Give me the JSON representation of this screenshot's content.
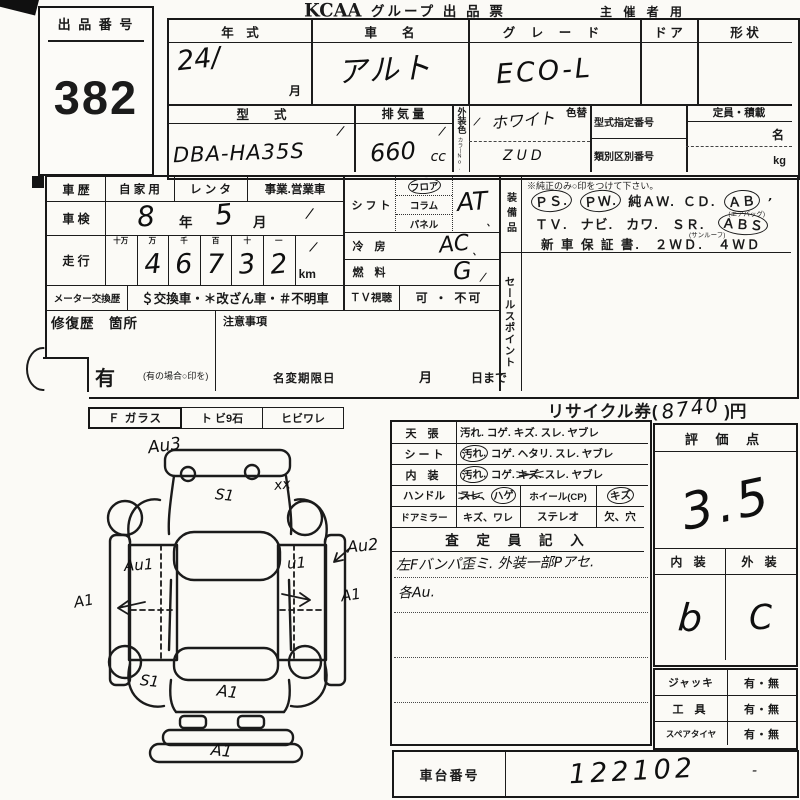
{
  "colors": {
    "ink": "#1c1c1c",
    "paper": "#fbfaf6"
  },
  "marks": {
    "tick": "/",
    "tick2": "、",
    "apos": "’",
    "dash": "-"
  },
  "header": {
    "lot_label": "出 品 番 号",
    "lot_number": "382",
    "brand": "KCAA",
    "title": "グループ 出 品 票",
    "audience": "主 催 者 用"
  },
  "top_table": {
    "year_label": "年　式",
    "year_value": "24/",
    "month_label": "月",
    "name_label": "車　　名",
    "name_value": "アルト",
    "grade_label": "グ レ ー ド",
    "grade_value": "ECO-L",
    "door_label": "ド ア",
    "shape_label": "形 状",
    "model_label": "型　　式",
    "model_value": "DBA-HA35S",
    "disp_label": "排 気 量",
    "disp_value": "660",
    "disp_unit": "cc",
    "ext_color_label": "外装色",
    "color_no_label": "カラーNo.",
    "color_change_label": "色替",
    "color_value": "ホワイト",
    "color_no_value": "ZUD",
    "type_no_label": "型式指定番号",
    "class_no_label": "類別区別番号",
    "capacity_label": "定員・積載",
    "persons_unit": "名",
    "weight_unit": "kg"
  },
  "history": {
    "label": "車 歴",
    "private": "自 家 用",
    "rental": "レ ン タ",
    "business": "事業.営業車",
    "inspection_label": "車 検",
    "insp_year": "8",
    "insp_year_suffix": "年",
    "insp_month": "5",
    "insp_month_suffix": "月",
    "mileage_label": "走 行",
    "digit_headers": [
      "十万",
      "万",
      "千",
      "百",
      "十",
      "一"
    ],
    "digits": [
      "",
      "4",
      "6",
      "7",
      "3",
      "2"
    ],
    "mileage_unit": "km",
    "meter_label": "メーター交換歴",
    "meter_options": "＄交換車・＊改ざん車・＃不明車",
    "tv_label": "ＴＶ視聴",
    "tv_options": "可 ・ 不可",
    "repair_label": "修復歴　箇所",
    "caution_label": "注意事項",
    "exist_label": "有",
    "exist_note": "(有の場合○印を)",
    "name_change_label": "名変期限日",
    "nc_month": "月",
    "nc_day": "日まで"
  },
  "drivetrain": {
    "shift_label": "シ フ ト",
    "shift_opt1": "フロア",
    "shift_opt2": "コラム",
    "shift_opt3": "パネル",
    "shift_value": "AT",
    "ac_label": "冷 房",
    "ac_value": "AC",
    "fuel_label": "燃 料",
    "fuel_value": "G"
  },
  "equipment": {
    "label": "装備品",
    "note": "※純正のみ○印をつけて下さい。",
    "ps": "ＰＳ.",
    "pw": "ＰＷ.",
    "aw": "純ＡＷ.",
    "cd": "ＣＤ.",
    "ab": "ＡＢ",
    "ab_sub": "(エアバッグ)",
    "tv": "ＴＶ.",
    "navi": "ナビ.",
    "kawa": "カワ.",
    "sr": "ＳＲ.",
    "sr_sub": "(サンルーフ)",
    "abs": "ＡＢＳ",
    "warranty": "新 車 保 証 書.",
    "wd2": "２ＷＤ.",
    "wd4": "４ＷＤ"
  },
  "sales_point_label": "セールスポイント",
  "recycle": {
    "pre": "リサイクル券(",
    "value": "8740",
    "post": ")円"
  },
  "glass": {
    "f_label": "Ｆ ガラス",
    "stone_label": "ト ビ9石",
    "crack_label": "ヒビワレ"
  },
  "diagram": {
    "annotations": [
      {
        "label": "Au3"
      },
      {
        "label": "xx"
      },
      {
        "label": "S1"
      },
      {
        "label": "Au1"
      },
      {
        "label": "u1"
      },
      {
        "label": "Au2"
      },
      {
        "label": "A1"
      },
      {
        "label": "A1"
      },
      {
        "label": "S1"
      },
      {
        "label": "A1"
      },
      {
        "label": "A1"
      }
    ]
  },
  "condition": {
    "ceiling_label": "天 張",
    "ceiling_first": "汚れ.",
    "ceiling_rest": "コゲ. キズ. スレ. ヤブレ",
    "seat_label": "シ ー ト",
    "seat_first": "汚れ.",
    "seat_rest": "コゲ. ヘタリ. スレ. ヤブレ",
    "interior_label": "内 装",
    "interior_first": "汚れ.",
    "interior_mid": "コゲ.",
    "interior_kizu": "キズ.",
    "interior_rest": "スレ. ヤブレ",
    "handle_label": "ハンドル",
    "handle_a": "スレ",
    "handle_sep": "、",
    "handle_b": "ハゲ",
    "wheel_label": "ホイール(CP)",
    "wheel_kizu": "キズ",
    "mirror_label": "ドアミラー",
    "mirror_items": "キズ、ワレ",
    "stereo_label": "ステレオ",
    "stereo_items": "欠、穴",
    "inspector_label": "査 定 員 記 入",
    "note1": "左Fバンパ歪ミ. 外装一部Pアセ.",
    "note2": "各Au."
  },
  "score": {
    "label": "評 価 点",
    "value": "3.5",
    "interior_label": "内 装",
    "exterior_label": "外 装",
    "interior_value": "b",
    "exterior_value": "C"
  },
  "accessories": {
    "jack_label": "ジャッキ",
    "tool_label": "工 具",
    "spare_label": "スペアタイヤ",
    "options": "有・無"
  },
  "chassis": {
    "label": "車台番号",
    "value": "122102"
  }
}
